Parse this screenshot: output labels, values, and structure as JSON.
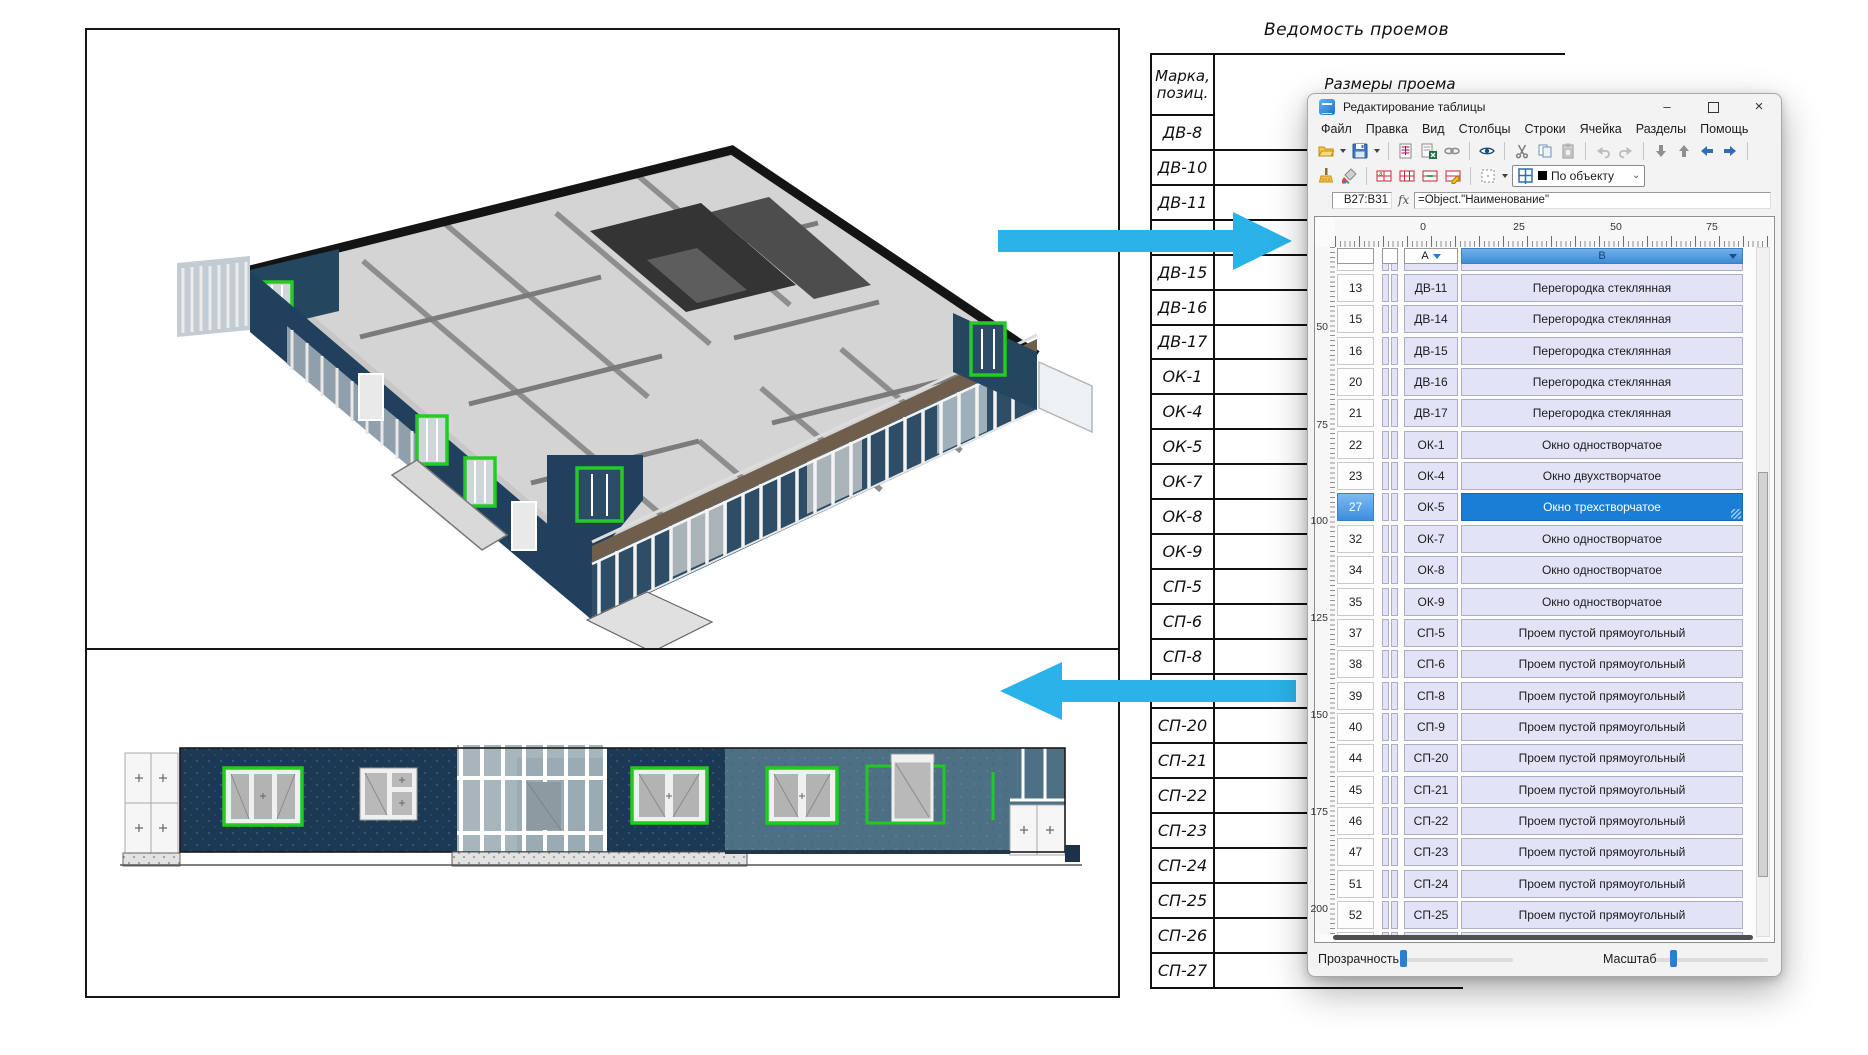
{
  "colors": {
    "arrow": "#29b3e8",
    "selection_blue": "#1b7ed6",
    "cell_lavender": "#e3e3f8",
    "header_b_blue": "#4f97e3",
    "green_highlight": "#1ecb1e",
    "navy_wall": "#1c3954",
    "slate_wall": "#4d7085"
  },
  "bg_table": {
    "title": "Ведомость проемов",
    "col1_header_line1": "Марка,",
    "col1_header_line2": "позиц.",
    "col2_header": "Размеры проема",
    "rows": [
      {
        "mark": "ДВ-8",
        "fragment": "Дверь балко"
      },
      {
        "mark": "ДВ-10",
        "fragment": "Пер"
      },
      {
        "mark": "ДВ-11",
        "fragment": "Пер"
      },
      {
        "mark": "ДВ-14",
        "fragment": "Пер"
      },
      {
        "mark": "ДВ-15",
        "fragment": "Пер"
      },
      {
        "mark": "ДВ-16",
        "fragment": "Пер"
      },
      {
        "mark": "ДВ-17",
        "fragment": "Пер"
      },
      {
        "mark": "ОК-1",
        "fragment": "Ок"
      },
      {
        "mark": "ОК-4",
        "fragment": "Ок"
      },
      {
        "mark": "ОК-5",
        "fragment": "Ок"
      },
      {
        "mark": "ОК-7",
        "fragment": "Ок"
      },
      {
        "mark": "ОК-8",
        "fragment": "Ок"
      },
      {
        "mark": "ОК-9",
        "fragment": "Ок"
      },
      {
        "mark": "СП-5",
        "fragment": "Проем"
      },
      {
        "mark": "СП-6",
        "fragment": "Проем"
      },
      {
        "mark": "СП-8",
        "fragment": "Проем"
      },
      {
        "mark": "СП-9",
        "fragment": "Проем"
      },
      {
        "mark": "СП-20",
        "fragment": "Проем"
      },
      {
        "mark": "СП-21",
        "fragment": "Проем"
      },
      {
        "mark": "СП-22",
        "fragment": "Проем"
      },
      {
        "mark": "СП-23",
        "fragment": "Проем"
      },
      {
        "mark": "СП-24",
        "fragment": "Проем"
      },
      {
        "mark": "СП-25",
        "fragment": "Проем"
      },
      {
        "mark": "СП-26",
        "fragment": "Проем"
      },
      {
        "mark": "СП-27",
        "fragment": "Проем"
      }
    ]
  },
  "dialog": {
    "title": "Редактирование таблицы",
    "window_buttons": {
      "minimize": "–",
      "maximize": "",
      "close": "×"
    },
    "menus": [
      "Файл",
      "Правка",
      "Вид",
      "Столбцы",
      "Строки",
      "Ячейка",
      "Разделы",
      "Помощь"
    ],
    "toolbar": {
      "style_combo_label": "По объекту"
    },
    "formula_bar": {
      "cell_ref": "B27:B31",
      "fx": "fx",
      "formula": "=Object.\"Наименование\""
    },
    "ruler": {
      "horizontal": [
        "0",
        "25",
        "50",
        "75"
      ],
      "vertical": [
        "50",
        "75",
        "100",
        "125",
        "150",
        "175",
        "200"
      ]
    },
    "grid": {
      "columns": [
        "A",
        "B"
      ],
      "rows": [
        {
          "n": "13",
          "a": "ДВ-11",
          "b": "Перегородка стеклянная",
          "sel": false
        },
        {
          "n": "15",
          "a": "ДВ-14",
          "b": "Перегородка стеклянная",
          "sel": false
        },
        {
          "n": "16",
          "a": "ДВ-15",
          "b": "Перегородка стеклянная",
          "sel": false
        },
        {
          "n": "20",
          "a": "ДВ-16",
          "b": "Перегородка стеклянная",
          "sel": false
        },
        {
          "n": "21",
          "a": "ДВ-17",
          "b": "Перегородка стеклянная",
          "sel": false
        },
        {
          "n": "22",
          "a": "ОК-1",
          "b": "Окно одностворчатое",
          "sel": false
        },
        {
          "n": "23",
          "a": "ОК-4",
          "b": "Окно двухстворчатое",
          "sel": false
        },
        {
          "n": "27",
          "a": "ОК-5",
          "b": "Окно трехстворчатое",
          "sel": true
        },
        {
          "n": "32",
          "a": "ОК-7",
          "b": "Окно одностворчатое",
          "sel": false
        },
        {
          "n": "34",
          "a": "ОК-8",
          "b": "Окно одностворчатое",
          "sel": false
        },
        {
          "n": "35",
          "a": "ОК-9",
          "b": "Окно одностворчатое",
          "sel": false
        },
        {
          "n": "37",
          "a": "СП-5",
          "b": "Проем пустой прямоугольный",
          "sel": false
        },
        {
          "n": "38",
          "a": "СП-6",
          "b": "Проем пустой прямоугольный",
          "sel": false
        },
        {
          "n": "39",
          "a": "СП-8",
          "b": "Проем пустой прямоугольный",
          "sel": false
        },
        {
          "n": "40",
          "a": "СП-9",
          "b": "Проем пустой прямоугольный",
          "sel": false
        },
        {
          "n": "44",
          "a": "СП-20",
          "b": "Проем пустой прямоугольный",
          "sel": false
        },
        {
          "n": "45",
          "a": "СП-21",
          "b": "Проем пустой прямоугольный",
          "sel": false
        },
        {
          "n": "46",
          "a": "СП-22",
          "b": "Проем пустой прямоугольный",
          "sel": false
        },
        {
          "n": "47",
          "a": "СП-23",
          "b": "Проем пустой прямоугольный",
          "sel": false
        },
        {
          "n": "51",
          "a": "СП-24",
          "b": "Проем пустой прямоугольный",
          "sel": false
        },
        {
          "n": "52",
          "a": "СП-25",
          "b": "Проем пустой прямоугольный",
          "sel": false
        }
      ]
    },
    "bottom_bar": {
      "transparency_label": "Прозрачность",
      "scale_label": "Масштаб"
    }
  }
}
